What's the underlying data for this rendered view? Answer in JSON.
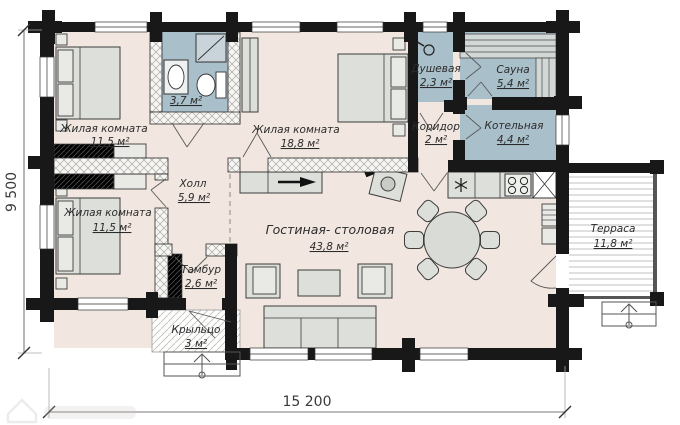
{
  "rooms": {
    "bedroom1": {
      "label": "Жилая комната",
      "area": "11,5 м²"
    },
    "bathroom": {
      "area": "3,7 м²"
    },
    "bedroom2": {
      "label": "Жилая комната",
      "area": "18,8 м²"
    },
    "shower": {
      "label": "Душевая",
      "area": "2,3 м²"
    },
    "sauna": {
      "label": "Сауна",
      "area": "5,4 м²"
    },
    "boiler": {
      "label": "Котельная",
      "area": "4,4 м²"
    },
    "corridor": {
      "label": "Коридор",
      "area": "2 м²"
    },
    "hall": {
      "label": "Холл",
      "area": "5,9 м²"
    },
    "bedroom3": {
      "label": "Жилая комната",
      "area": "11,5 м²"
    },
    "vestibule": {
      "label": "Тамбур",
      "area": "2,6 м²"
    },
    "porch": {
      "label": "Крыльцо",
      "area": "3 м²"
    },
    "living": {
      "label": "Гостиная- столовая",
      "area": "43,8 м²"
    },
    "terrace": {
      "label": "Терраса",
      "area": "11,8 м²"
    }
  },
  "dimensions": {
    "overall_width": "15 200",
    "overall_height": "9 500"
  },
  "colors": {
    "wall": "#181818",
    "floor": "#f1e7e0",
    "wet_room": "#a9bfca",
    "furniture": "#dcdfda"
  }
}
